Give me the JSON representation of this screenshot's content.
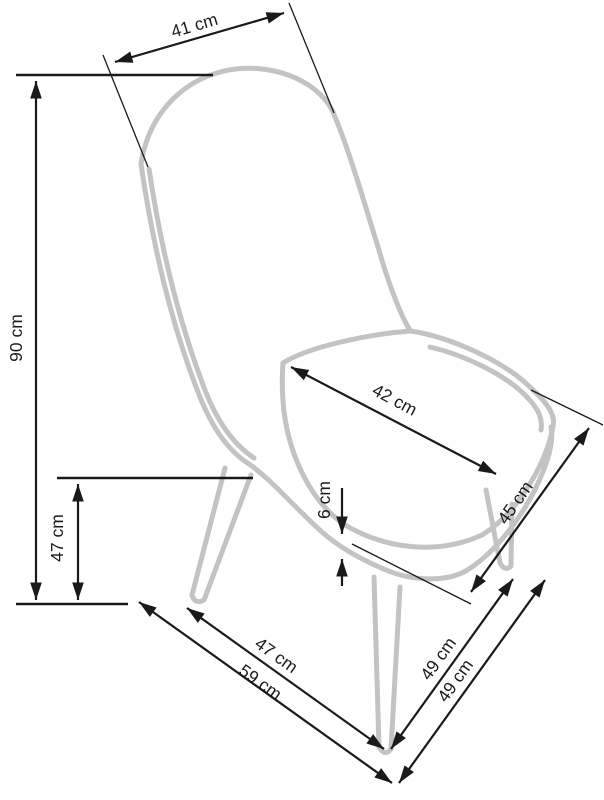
{
  "diagram": {
    "title": "Chair dimension drawing",
    "unit": "cm",
    "colors": {
      "background": "#ffffff",
      "chair_outline": "#c3c3c3",
      "dimension_lines": "#1a1a1a",
      "label_text": "#1a1a1a"
    },
    "labels": {
      "backrest_width": "41 cm",
      "total_height": "90 cm",
      "seat_width": "42 cm",
      "seat_height": "47 cm",
      "seat_thickness": "6 cm",
      "seat_depth": "45 cm",
      "front_leg_span": "47 cm",
      "base_depth": "59 cm",
      "side_leg_span_inner": "49 cm",
      "side_leg_span_outer": "49 cm"
    },
    "values": {
      "backrest_width_cm": 41,
      "total_height_cm": 90,
      "seat_width_cm": 42,
      "seat_height_cm": 47,
      "seat_thickness_cm": 6,
      "seat_depth_cm": 45,
      "front_leg_span_cm": 47,
      "base_depth_cm": 59,
      "side_leg_span_inner_cm": 49,
      "side_leg_span_outer_cm": 49
    }
  }
}
